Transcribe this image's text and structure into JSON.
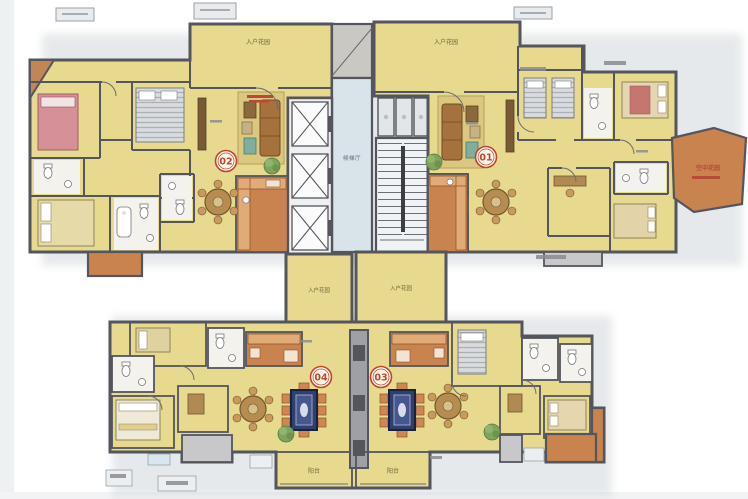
{
  "plan_labels": {
    "entry_garden": "入户花园",
    "elevator_lobby": "候梯厅",
    "balcony": "阳台",
    "sky_garden": "空中花园"
  },
  "unit_badges": {
    "u01": "01",
    "u02": "02",
    "u03": "03",
    "u04": "04"
  },
  "colors": {
    "room_fill": "#e7d98e",
    "kitchen_orange": "#c8834f",
    "core_blue": "#d8e3ea",
    "wall_gray": "#54555d",
    "balcony_gray": "#c8c8ca",
    "badge_red": "#c0452f",
    "annotation_red": "#b84a38"
  }
}
